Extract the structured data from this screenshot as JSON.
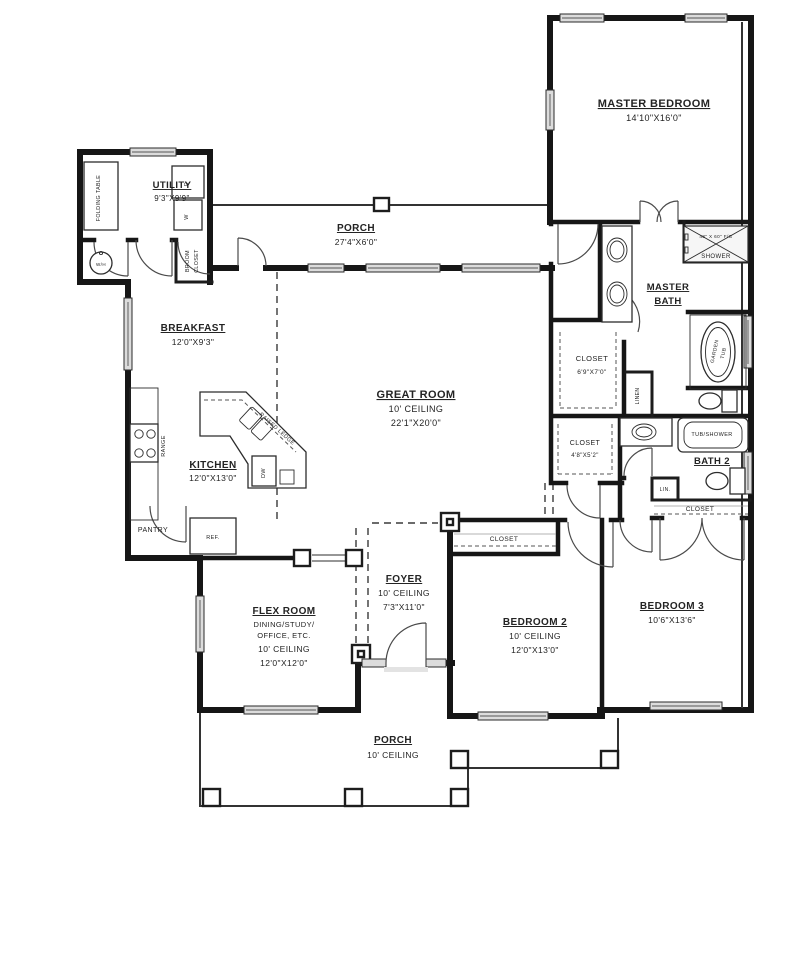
{
  "palette": {
    "ink": "#161616",
    "paper": "#ffffff",
    "window_gray": "#dcdcdc"
  },
  "plan": {
    "rooms": {
      "master_bedroom": {
        "name": "MASTER BEDROOM",
        "dims": "14'10\"X16'0\""
      },
      "utility": {
        "name": "UTILITY",
        "dims": "9'3\"X9'9\""
      },
      "porch_rear": {
        "name": "PORCH",
        "dims": "27'4\"X6'0\""
      },
      "master_bath": {
        "line1": "MASTER",
        "line2": "BATH"
      },
      "master_closet": {
        "name": "CLOSET",
        "dims": "6'9\"X7'0\""
      },
      "breakfast": {
        "name": "BREAKFAST",
        "dims": "12'0\"X9'3\""
      },
      "great_room": {
        "name": "GREAT ROOM",
        "ceiling": "10' CEILING",
        "dims": "22'1\"X20'0\""
      },
      "kitchen": {
        "name": "KITCHEN",
        "dims": "12'0\"X13'0\""
      },
      "hall_closet": {
        "name": "CLOSET",
        "dims": "4'8\"X5'2\""
      },
      "bath2": {
        "name": "BATH 2"
      },
      "foyer": {
        "name": "FOYER",
        "ceiling": "10' CEILING",
        "dims": "7'3\"X11'0\""
      },
      "flex_room": {
        "name": "FLEX ROOM",
        "sub1": "DINING/STUDY/",
        "sub2": "OFFICE, ETC.",
        "ceiling": "10' CEILING",
        "dims": "12'0\"X12'0\""
      },
      "bedroom2": {
        "name": "BEDROOM 2",
        "ceiling": "10' CEILING",
        "dims": "12'0\"X13'0\""
      },
      "bedroom3": {
        "name": "BEDROOM 3",
        "dims": "10'6\"X13'6\""
      },
      "porch_front": {
        "name": "PORCH",
        "ceiling": "10' CEILING"
      }
    },
    "fixtures": {
      "folding_table": "FOLDING TABLE",
      "wh": "W/H",
      "dryer": "D",
      "washer": "W",
      "broom1": "BROOM",
      "broom2": "CLOSET",
      "shower_size": "48\" X 60\" F/G",
      "shower": "SHOWER",
      "garden1": "GARDEN",
      "garden2": "TUB",
      "linen": "LINEN",
      "lin": "LIN.",
      "range": "RANGE",
      "raised_ledge": "RAISED LEDGE",
      "dw": "DW",
      "pantry": "PANTRY",
      "ref": "REF.",
      "tub_shower": "TUB/SHOWER",
      "bedroom2_closet": "CLOSET",
      "bedroom3_closet": "CLOSET"
    }
  }
}
